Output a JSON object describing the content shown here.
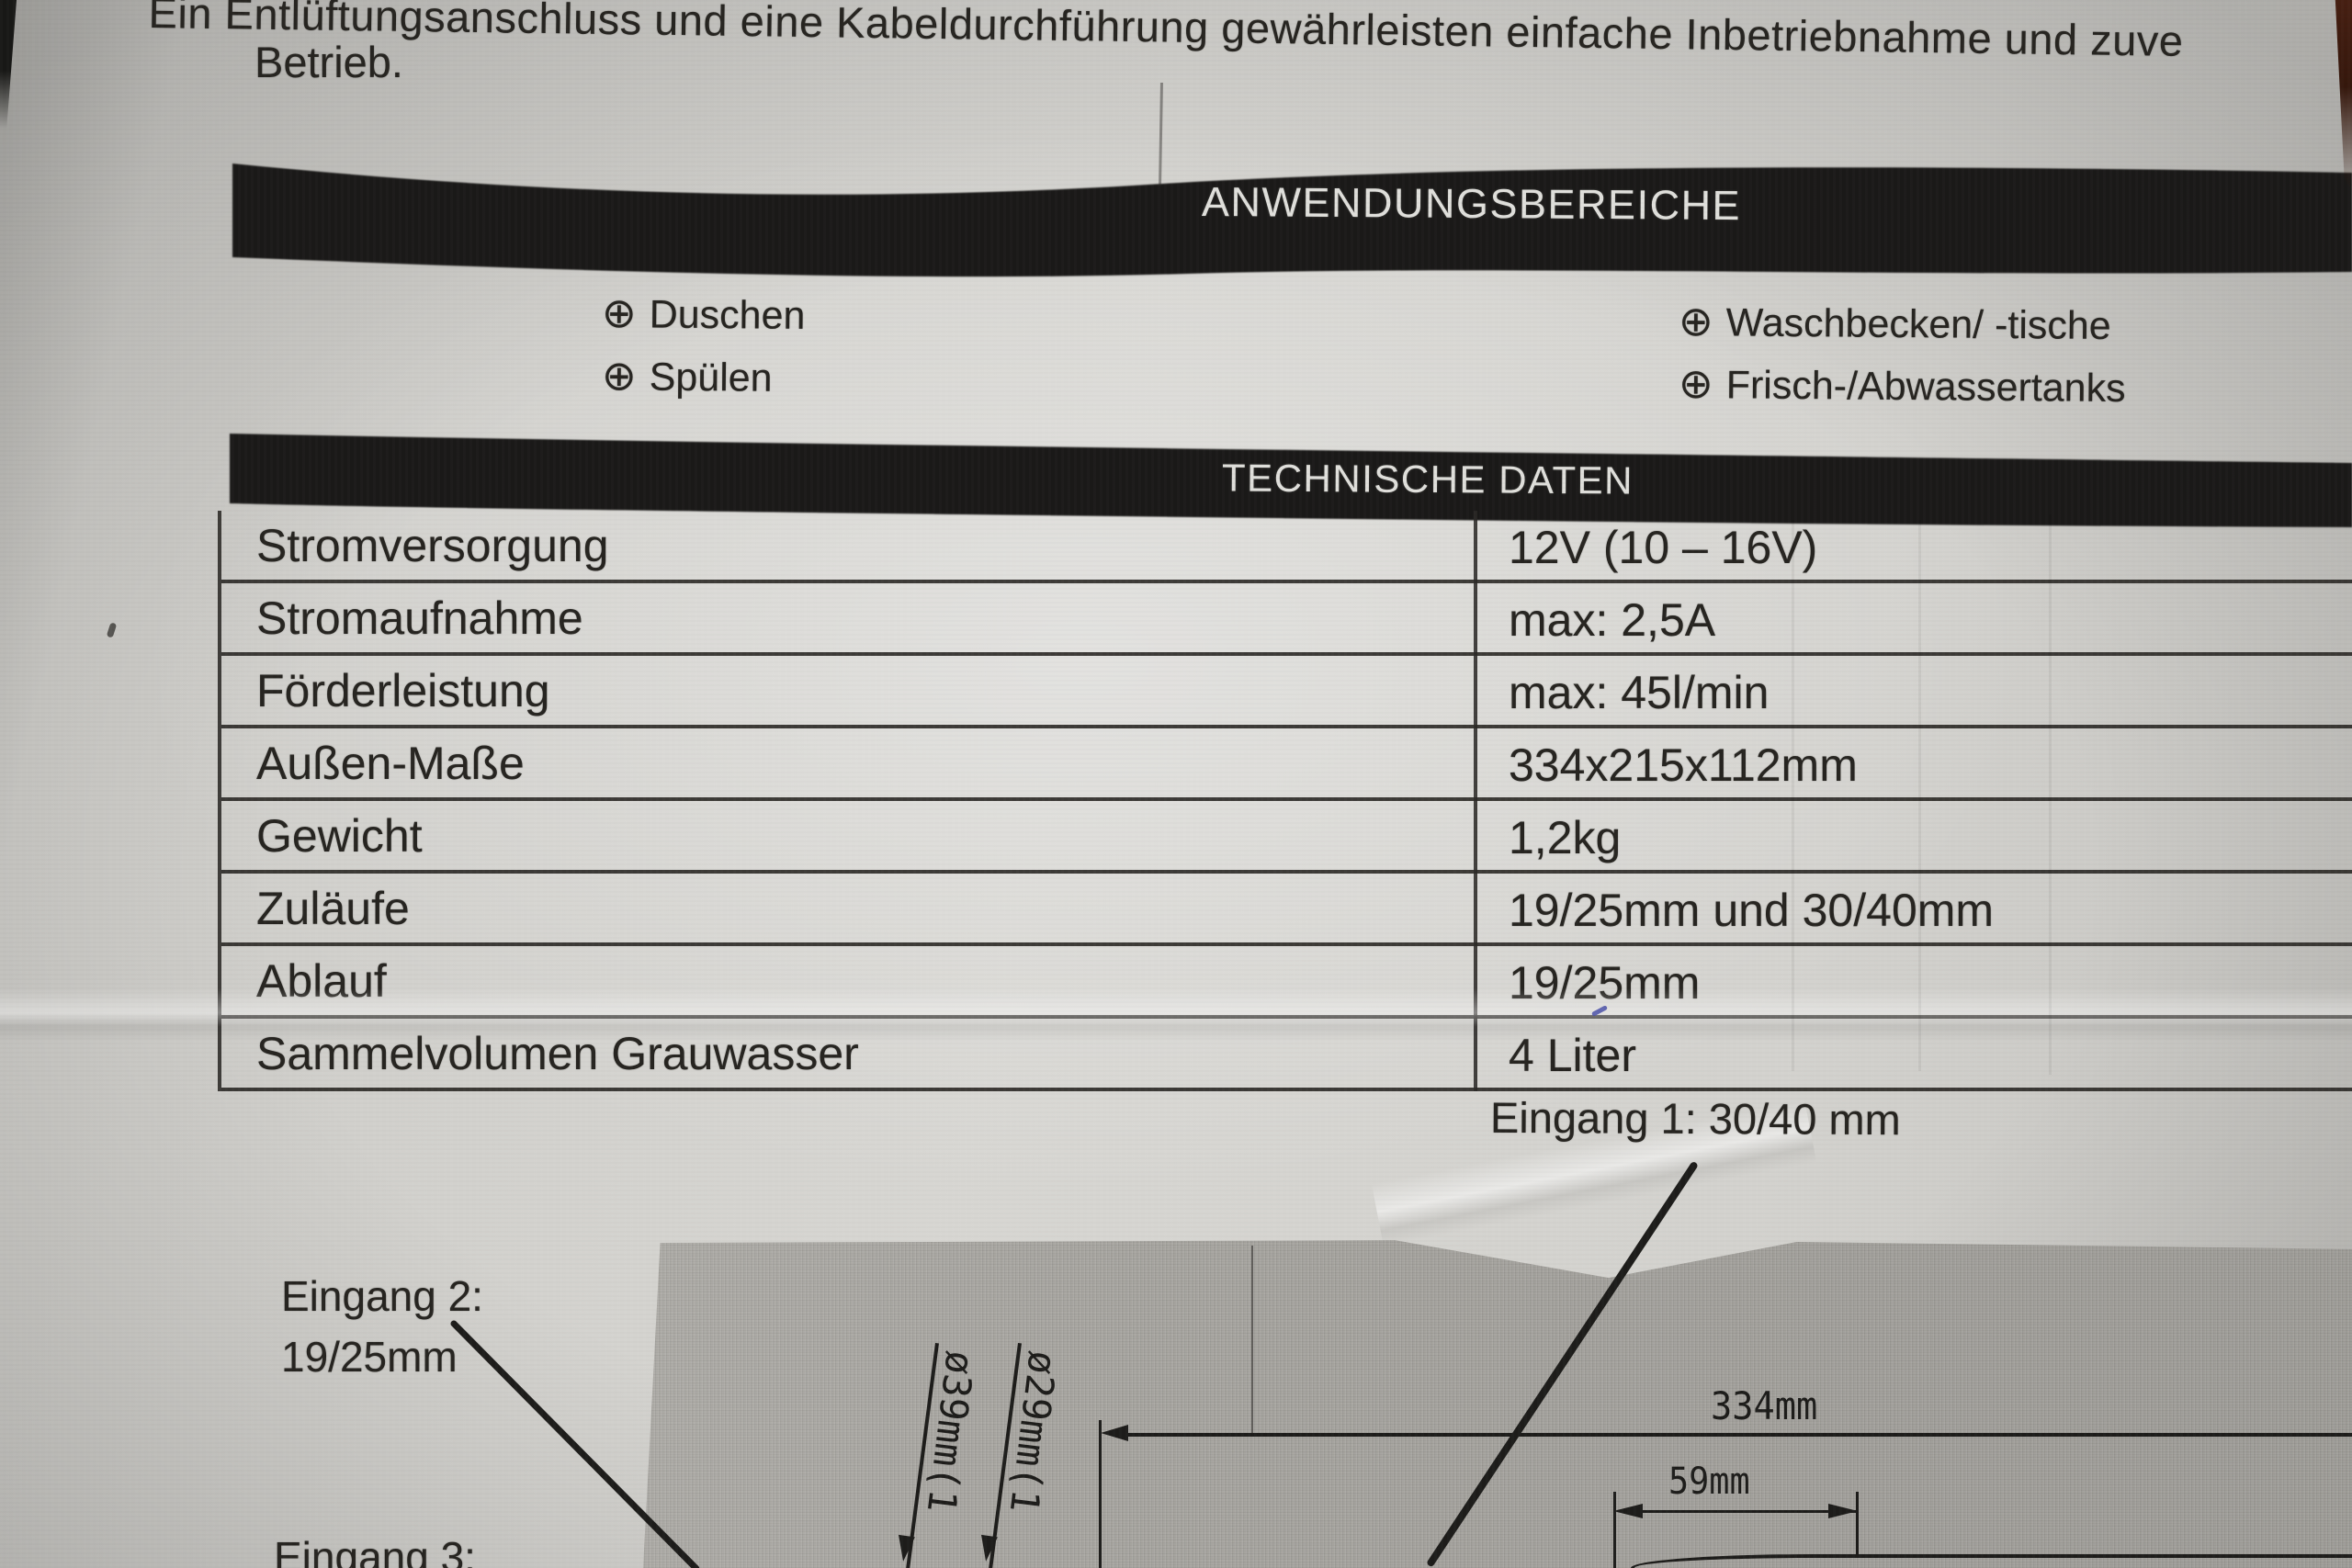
{
  "intro": {
    "line1": "Ein Entlüftungsanschluss und eine Kabeldurchführung gewährleisten einfache Inbetriebnahme und zuve",
    "line2": "Betrieb."
  },
  "applications": {
    "title": "ANWENDUNGSBEREICHE",
    "bullet": "⊕",
    "left_items": [
      "Duschen",
      "Spülen"
    ],
    "right_items": [
      "Waschbecken/ -tische",
      "Frisch-/Abwassertanks"
    ]
  },
  "technical": {
    "title": "TECHNISCHE DATEN",
    "rows": [
      {
        "label": "Stromversorgung",
        "value": "12V (10 – 16V)"
      },
      {
        "label": "Stromaufnahme",
        "value": "max: 2,5A"
      },
      {
        "label": "Förderleistung",
        "value": "max: 45l/min"
      },
      {
        "label": "Außen-Maße",
        "value": "334x215x112mm"
      },
      {
        "label": "Gewicht",
        "value": "1,2kg"
      },
      {
        "label": "Zuläufe",
        "value": "19/25mm und 30/40mm"
      },
      {
        "label": "Ablauf",
        "value": "19/25mm"
      },
      {
        "label": "Sammelvolumen Grauwasser",
        "value": "4 Liter"
      }
    ]
  },
  "diagram": {
    "eingang1_label": "Eingang 1: 30/40 mm",
    "eingang2_line1": "Eingang 2:",
    "eingang2_line2": "19/25mm",
    "eingang3_label": "Eingang 3:",
    "dim_width_total": "334mm",
    "dim_width_small": "59mm",
    "dia_label_39": "ø39mm(1",
    "dia_label_29": "ø29mm(1"
  },
  "colors": {
    "paper": "#d3d2ce",
    "ink": "#262420",
    "banner_bg": "#1a1918",
    "banner_text": "#e0dfdb",
    "table_line": "#2c2a27",
    "diagram_gray": "#a8a6a1",
    "pen_mark_blue": "#4b51a8"
  }
}
